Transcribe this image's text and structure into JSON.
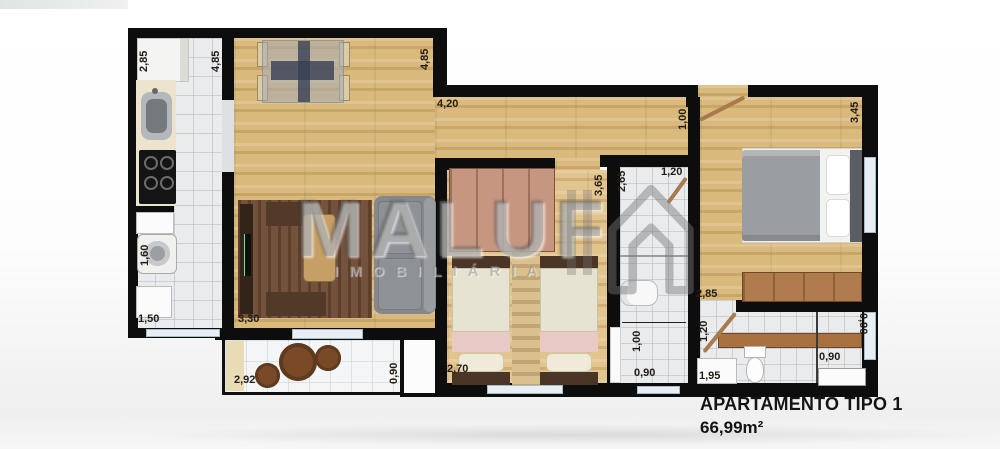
{
  "title": {
    "line1": "APARTAMENTO TIPO 1",
    "line2": "66,99m²"
  },
  "watermark": {
    "brand": "MALUF",
    "subtitle": "IMOBILIÁRIA",
    "icon": "house-outline-icon"
  },
  "dimensions": {
    "kitchen_width": "2,85",
    "kitchen_depth": "4,85",
    "living_top_depth": "4,85",
    "hall_width": "4,20",
    "entry_door_width": "1,00",
    "master_depth": "3,45",
    "bedroom2_depth": "3,65",
    "bath_depth": "2,65",
    "bath_door_width": "1,20",
    "master_width": "2,85",
    "ensuite_door_width": "1,20",
    "service_width": "1,60",
    "service_depth": "1,50",
    "living_width": "3,30",
    "balcony_width": "2,92",
    "balcony_depth": "0,90",
    "bedroom2_width": "2,70",
    "bath_inner_width": "1,00",
    "bath_bottom_width": "0,90",
    "ensuite_counter_width": "1,95",
    "shower_width": "0,90",
    "ensuite_window_width": "0,90"
  },
  "colors": {
    "wall": "#0d0d0d",
    "wood_floor": "#d9b97c",
    "tile_floor": "#e9ebed",
    "watermark_gray": "#767676",
    "door_leaf": "#a97a4e",
    "furniture_brown": "#a9713f"
  }
}
